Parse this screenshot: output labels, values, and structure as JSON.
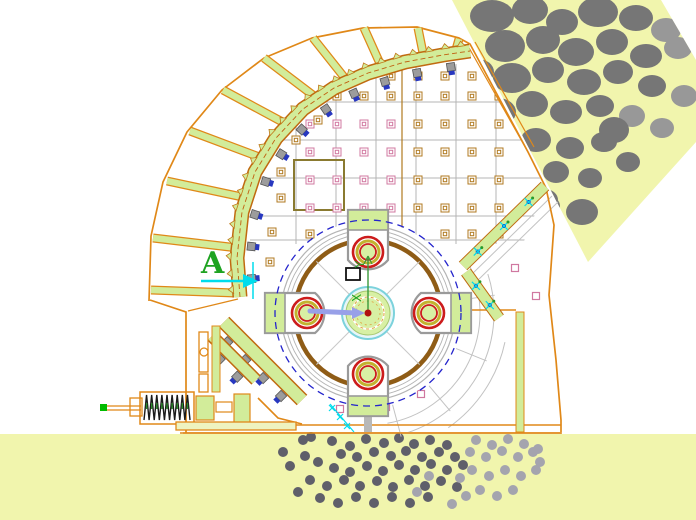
{
  "labels": {
    "section_marker": "A",
    "axis_y": "Y",
    "axis_x": "X"
  },
  "palette": {
    "bg": "#ffffff",
    "paleYellow": "#f1f5ad",
    "orange": "#e08818",
    "orangeDark": "#c06a10",
    "green": "#d2ec9a",
    "greenEdge": "#8aa845",
    "brown": "#8f5c16",
    "grayLine": "#b4b4b4",
    "rock": "#767676",
    "rockLight": "#989898",
    "dotDark": "#5f5f6a",
    "dotLight": "#a4a4ae",
    "blue": "#2424cc",
    "lavender": "#98a0e8",
    "cyan": "#00dcec",
    "red": "#cc1c1c",
    "ringYellow": "#c2b22e",
    "hubGreen": "#d8f0a4",
    "hubCyan": "#7cd2dc",
    "pink": "#d078a0",
    "boltGray": "#9c9c9c",
    "boltBlue": "#2838c0",
    "textGreen": "#1ea321",
    "tanMark": "#b07a20"
  },
  "drawing": {
    "hopper_polygon": [
      [
        452,
        0
      ],
      [
        661,
        0
      ],
      [
        696,
        60
      ],
      [
        696,
        142
      ],
      [
        588,
        262
      ]
    ],
    "floor": {
      "y": 434,
      "edge_line": [
        180,
        433,
        562,
        433
      ]
    },
    "rocks": [
      [
        492,
        16,
        22,
        16,
        0
      ],
      [
        530,
        10,
        18,
        14,
        0
      ],
      [
        562,
        22,
        16,
        13,
        0
      ],
      [
        598,
        12,
        20,
        15,
        0
      ],
      [
        636,
        18,
        17,
        13,
        0
      ],
      [
        666,
        30,
        15,
        12,
        1
      ],
      [
        505,
        46,
        20,
        16,
        0
      ],
      [
        543,
        40,
        17,
        14,
        0
      ],
      [
        576,
        52,
        18,
        14,
        0
      ],
      [
        612,
        42,
        16,
        13,
        0
      ],
      [
        646,
        56,
        16,
        12,
        0
      ],
      [
        678,
        48,
        14,
        11,
        1
      ],
      [
        478,
        72,
        16,
        13,
        0
      ],
      [
        512,
        78,
        19,
        15,
        0
      ],
      [
        548,
        70,
        16,
        13,
        0
      ],
      [
        584,
        82,
        17,
        13,
        0
      ],
      [
        618,
        72,
        15,
        12,
        0
      ],
      [
        652,
        86,
        14,
        11,
        0
      ],
      [
        684,
        96,
        13,
        11,
        1
      ],
      [
        468,
        106,
        14,
        12,
        0
      ],
      [
        498,
        112,
        18,
        14,
        0
      ],
      [
        532,
        104,
        16,
        13,
        0
      ],
      [
        566,
        112,
        16,
        12,
        0
      ],
      [
        600,
        106,
        14,
        11,
        0
      ],
      [
        632,
        116,
        13,
        11,
        1
      ],
      [
        470,
        140,
        13,
        11,
        0
      ],
      [
        502,
        148,
        16,
        13,
        0
      ],
      [
        536,
        140,
        15,
        12,
        0
      ],
      [
        570,
        148,
        14,
        11,
        0
      ],
      [
        604,
        142,
        13,
        10,
        0
      ],
      [
        662,
        128,
        12,
        10,
        1
      ],
      [
        486,
        176,
        14,
        11,
        0
      ],
      [
        520,
        182,
        15,
        12,
        0
      ],
      [
        556,
        172,
        13,
        11,
        0
      ],
      [
        590,
        178,
        12,
        10,
        0
      ],
      [
        478,
        206,
        12,
        10,
        0
      ],
      [
        512,
        212,
        13,
        11,
        0
      ],
      [
        548,
        206,
        12,
        10,
        0
      ],
      [
        582,
        212,
        16,
        13,
        0
      ],
      [
        498,
        238,
        11,
        9,
        0
      ],
      [
        532,
        232,
        11,
        9,
        1
      ],
      [
        614,
        130,
        15,
        13,
        0
      ],
      [
        545,
        200,
        13,
        11,
        0
      ],
      [
        628,
        162,
        12,
        10,
        0
      ]
    ],
    "dots": [
      [
        303,
        440,
        0
      ],
      [
        332,
        441,
        0
      ],
      [
        350,
        446,
        0
      ],
      [
        366,
        439,
        0
      ],
      [
        384,
        443,
        0
      ],
      [
        399,
        438,
        0
      ],
      [
        414,
        444,
        0
      ],
      [
        430,
        440,
        0
      ],
      [
        447,
        445,
        0
      ],
      [
        341,
        454,
        0
      ],
      [
        357,
        457,
        0
      ],
      [
        374,
        452,
        0
      ],
      [
        391,
        456,
        0
      ],
      [
        406,
        451,
        0
      ],
      [
        422,
        457,
        0
      ],
      [
        439,
        452,
        0
      ],
      [
        455,
        457,
        0
      ],
      [
        305,
        456,
        0
      ],
      [
        318,
        462,
        0
      ],
      [
        334,
        468,
        0
      ],
      [
        350,
        472,
        0
      ],
      [
        367,
        466,
        0
      ],
      [
        383,
        471,
        0
      ],
      [
        399,
        465,
        0
      ],
      [
        415,
        470,
        0
      ],
      [
        431,
        464,
        0
      ],
      [
        447,
        470,
        0
      ],
      [
        463,
        465,
        0
      ],
      [
        310,
        480,
        0
      ],
      [
        327,
        486,
        0
      ],
      [
        344,
        480,
        0
      ],
      [
        360,
        486,
        0
      ],
      [
        377,
        481,
        0
      ],
      [
        393,
        487,
        0
      ],
      [
        409,
        480,
        0
      ],
      [
        425,
        486,
        0
      ],
      [
        441,
        481,
        0
      ],
      [
        457,
        487,
        0
      ],
      [
        320,
        498,
        0
      ],
      [
        338,
        503,
        0
      ],
      [
        356,
        497,
        0
      ],
      [
        374,
        503,
        0
      ],
      [
        392,
        497,
        0
      ],
      [
        410,
        503,
        0
      ],
      [
        428,
        497,
        0
      ],
      [
        283,
        452,
        0
      ],
      [
        290,
        466,
        0
      ],
      [
        298,
        492,
        0
      ],
      [
        311,
        437,
        0
      ],
      [
        476,
        440,
        1
      ],
      [
        492,
        445,
        1
      ],
      [
        508,
        439,
        1
      ],
      [
        524,
        444,
        1
      ],
      [
        538,
        449,
        1
      ],
      [
        470,
        452,
        1
      ],
      [
        486,
        457,
        1
      ],
      [
        502,
        451,
        1
      ],
      [
        518,
        457,
        1
      ],
      [
        533,
        452,
        1
      ],
      [
        472,
        470,
        1
      ],
      [
        489,
        476,
        1
      ],
      [
        505,
        470,
        1
      ],
      [
        521,
        476,
        1
      ],
      [
        536,
        470,
        1
      ],
      [
        480,
        490,
        1
      ],
      [
        497,
        496,
        1
      ],
      [
        513,
        490,
        1
      ],
      [
        460,
        478,
        1
      ],
      [
        466,
        496,
        1
      ],
      [
        452,
        504,
        1
      ],
      [
        540,
        462,
        1
      ],
      [
        429,
        476,
        1
      ],
      [
        417,
        492,
        1
      ]
    ],
    "shell": [
      [
        149,
        301
      ],
      [
        151,
        236
      ],
      [
        163,
        182
      ],
      [
        187,
        132
      ],
      [
        222,
        90
      ],
      [
        264,
        58
      ],
      [
        312,
        38
      ],
      [
        363,
        28
      ],
      [
        417,
        27
      ],
      [
        459,
        38
      ],
      [
        470,
        44
      ],
      [
        528,
        152
      ],
      [
        546,
        188
      ]
    ],
    "right_wall": [
      [
        546,
        188
      ],
      [
        554,
        225
      ],
      [
        549,
        295
      ],
      [
        556,
        360
      ],
      [
        561,
        420
      ],
      [
        561,
        432
      ]
    ],
    "left_wall": [
      [
        150,
        300
      ],
      [
        186,
        312
      ],
      [
        186,
        433
      ]
    ],
    "base_lines": [
      [
        183,
        425,
        561,
        425
      ],
      [
        183,
        433,
        561,
        433
      ]
    ],
    "ledge": [
      188,
      311,
      238,
      299
    ],
    "ribs": [
      [
        [
          151,
          290
        ],
        [
          235,
          293
        ]
      ],
      [
        [
          153,
          238
        ],
        [
          238,
          248
        ]
      ],
      [
        [
          167,
          181
        ],
        [
          247,
          198
        ]
      ],
      [
        [
          190,
          131
        ],
        [
          262,
          158
        ]
      ],
      [
        [
          223,
          90
        ],
        [
          288,
          125
        ]
      ],
      [
        [
          264,
          58
        ],
        [
          318,
          99
        ]
      ],
      [
        [
          313,
          38
        ],
        [
          348,
          82
        ]
      ],
      [
        [
          364,
          28
        ],
        [
          382,
          68
        ]
      ],
      [
        [
          418,
          28
        ],
        [
          424,
          58
        ]
      ],
      [
        [
          459,
          39
        ],
        [
          455,
          53
        ]
      ]
    ],
    "band": {
      "path": [
        [
          240,
          297
        ],
        [
          237,
          258
        ],
        [
          242,
          212
        ],
        [
          255,
          172
        ],
        [
          276,
          138
        ],
        [
          303,
          109
        ],
        [
          334,
          88
        ],
        [
          368,
          73
        ],
        [
          405,
          62
        ],
        [
          443,
          55
        ],
        [
          470,
          51
        ]
      ],
      "width": 12,
      "bolt_t": [
        0.045,
        0.135,
        0.225,
        0.315,
        0.405,
        0.495,
        0.585,
        0.675,
        0.765,
        0.855,
        0.945
      ],
      "teeth_n": 24
    },
    "feed_lip": [
      [
        [
          468,
          46
        ],
        [
          528,
          152
        ]
      ],
      [
        [
          475,
          42
        ],
        [
          534,
          147
        ]
      ]
    ],
    "aprons": [
      {
        "path": [
          [
            545,
            186
          ],
          [
            463,
            266
          ]
        ],
        "width": 10,
        "marks_t": [
          0.2,
          0.5,
          0.82
        ]
      },
      {
        "path": [
          [
            466,
            272
          ],
          [
            499,
            318
          ]
        ],
        "width": 10,
        "marks_t": [
          0.3,
          0.72
        ]
      }
    ],
    "apron_shadow": [
      [
        [
          552,
          196
        ],
        [
          470,
          276
        ]
      ],
      [
        [
          558,
          202
        ],
        [
          476,
          282
        ]
      ]
    ],
    "right_wall_green": [
      516,
      312,
      8,
      120
    ],
    "right_wall_top_line": [
      430,
      310,
      516,
      310
    ],
    "plates": {
      "clip": [
        [
          238,
          300
        ],
        [
          244,
          196
        ],
        [
          268,
          146
        ],
        [
          305,
          104
        ],
        [
          350,
          79
        ],
        [
          400,
          62
        ],
        [
          458,
          50
        ],
        [
          472,
          50
        ],
        [
          530,
          155
        ],
        [
          545,
          190
        ],
        [
          522,
          246
        ],
        [
          460,
          262
        ],
        [
          300,
          246
        ],
        [
          252,
          292
        ]
      ],
      "v_lines": [
        296,
        336,
        376,
        416,
        456,
        496
      ],
      "v_y": [
        64,
        244
      ],
      "h_lines": [
        102,
        140,
        178,
        216,
        240
      ],
      "h_x": [
        250,
        540
      ],
      "divider_x": 402,
      "divider_y": [
        66,
        240
      ],
      "highlight": [
        294,
        160,
        50,
        50
      ],
      "mark_rows": [
        76,
        96,
        124,
        152,
        180,
        208,
        234
      ],
      "mark_cols": [
        310,
        337,
        364,
        391,
        418,
        445,
        472,
        499
      ],
      "extra_marks": [
        [
          281,
          172,
          0
        ],
        [
          281,
          198,
          0
        ],
        [
          272,
          232,
          0
        ],
        [
          270,
          262,
          0
        ],
        [
          296,
          140,
          0
        ],
        [
          318,
          120,
          0
        ]
      ]
    },
    "rotor": {
      "cx": 368,
      "cy": 313,
      "r_white": 92,
      "r_dash": 93,
      "grays": [
        87,
        83,
        79
      ],
      "brown": 73,
      "hammer_r": 61,
      "hammer_angles": [
        -90,
        0,
        90,
        180
      ],
      "hub": {
        "r_cyan": 26,
        "r_green": 22,
        "r_dash1": 16,
        "r_dash2": 12,
        "dot": 3.5
      },
      "spokes": [
        45,
        135,
        225,
        315
      ],
      "keyway": [
        346,
        268,
        14,
        12
      ]
    },
    "arcs": [
      {
        "r": 112,
        "a1": -28,
        "a2": 80
      },
      {
        "r": 126,
        "a1": -18,
        "a2": 72
      },
      {
        "r": 140,
        "a1": 12,
        "a2": 55
      }
    ],
    "radials": [
      -8,
      22,
      50,
      75
    ],
    "grate_bars": [
      {
        "path": [
          [
            224,
            322
          ],
          [
            302,
            400
          ]
        ],
        "width": 12,
        "bolt_t": [
          0.15,
          0.38,
          0.61,
          0.84
        ]
      },
      {
        "path": [
          [
            212,
            336
          ],
          [
            256,
            380
          ]
        ],
        "width": 10,
        "bolt_t": [
          0.35,
          0.75
        ]
      }
    ],
    "hook": [
      [
        258,
        398
      ],
      [
        278,
        418
      ],
      [
        302,
        424
      ]
    ],
    "bracket": {
      "rect1": [
        199,
        332,
        9,
        40
      ],
      "rect2": [
        199,
        374,
        9,
        18
      ],
      "strip": [
        212,
        326,
        8,
        66
      ],
      "circle": [
        204,
        352,
        4
      ]
    },
    "spring": {
      "tip": [
        100,
        404,
        7,
        7
      ],
      "rod1": [
        [
          107,
          406
        ],
        [
          141,
          406
        ]
      ],
      "rod2": [
        [
          107,
          410
        ],
        [
          141,
          410
        ]
      ],
      "cross": [
        130,
        398,
        12,
        18
      ],
      "coil": {
        "x1": 144,
        "y1": 395,
        "x2": 190,
        "y2": 420,
        "n": 9
      },
      "frame": [
        140,
        392,
        54,
        32
      ],
      "block": [
        196,
        396,
        18,
        24
      ],
      "link": [
        216,
        402,
        16,
        10
      ],
      "bracket2": [
        234,
        394,
        16,
        32
      ],
      "base": [
        176,
        422,
        120,
        8
      ]
    },
    "marker": {
      "x": 201,
      "y": 273,
      "size": 30
    },
    "cyan_arrow": {
      "shaft": [
        [
          201,
          281
        ],
        [
          245,
          281
        ]
      ],
      "head": [
        [
          258,
          281
        ],
        [
          243,
          274
        ],
        [
          243,
          288
        ]
      ],
      "vline": [
        [
          253,
          262
        ],
        [
          253,
          299
        ]
      ]
    },
    "cyan_bits": [
      [
        332,
        408
      ],
      [
        340,
        417
      ],
      [
        347,
        426
      ]
    ],
    "cyan_streak": [
      [
        330,
        404
      ],
      [
        354,
        432
      ]
    ],
    "pink_squares": [
      [
        281,
        329
      ],
      [
        340,
        409
      ],
      [
        386,
        407
      ],
      [
        421,
        394
      ],
      [
        452,
        337
      ],
      [
        462,
        307
      ],
      [
        536,
        296
      ],
      [
        352,
        227
      ],
      [
        515,
        268
      ]
    ],
    "ucs": {
      "line": [
        [
          368,
          313
        ],
        [
          368,
          256
        ]
      ],
      "y_pos": [
        364,
        268
      ],
      "x_pos": [
        361,
        302
      ]
    },
    "arrow": {
      "shaft": [
        [
          310,
          311
        ],
        [
          356,
          313
        ]
      ],
      "head": [
        [
          365,
          313
        ],
        [
          352,
          307
        ],
        [
          352,
          319
        ]
      ]
    },
    "pillar": [
      364,
      408,
      8,
      24
    ]
  }
}
